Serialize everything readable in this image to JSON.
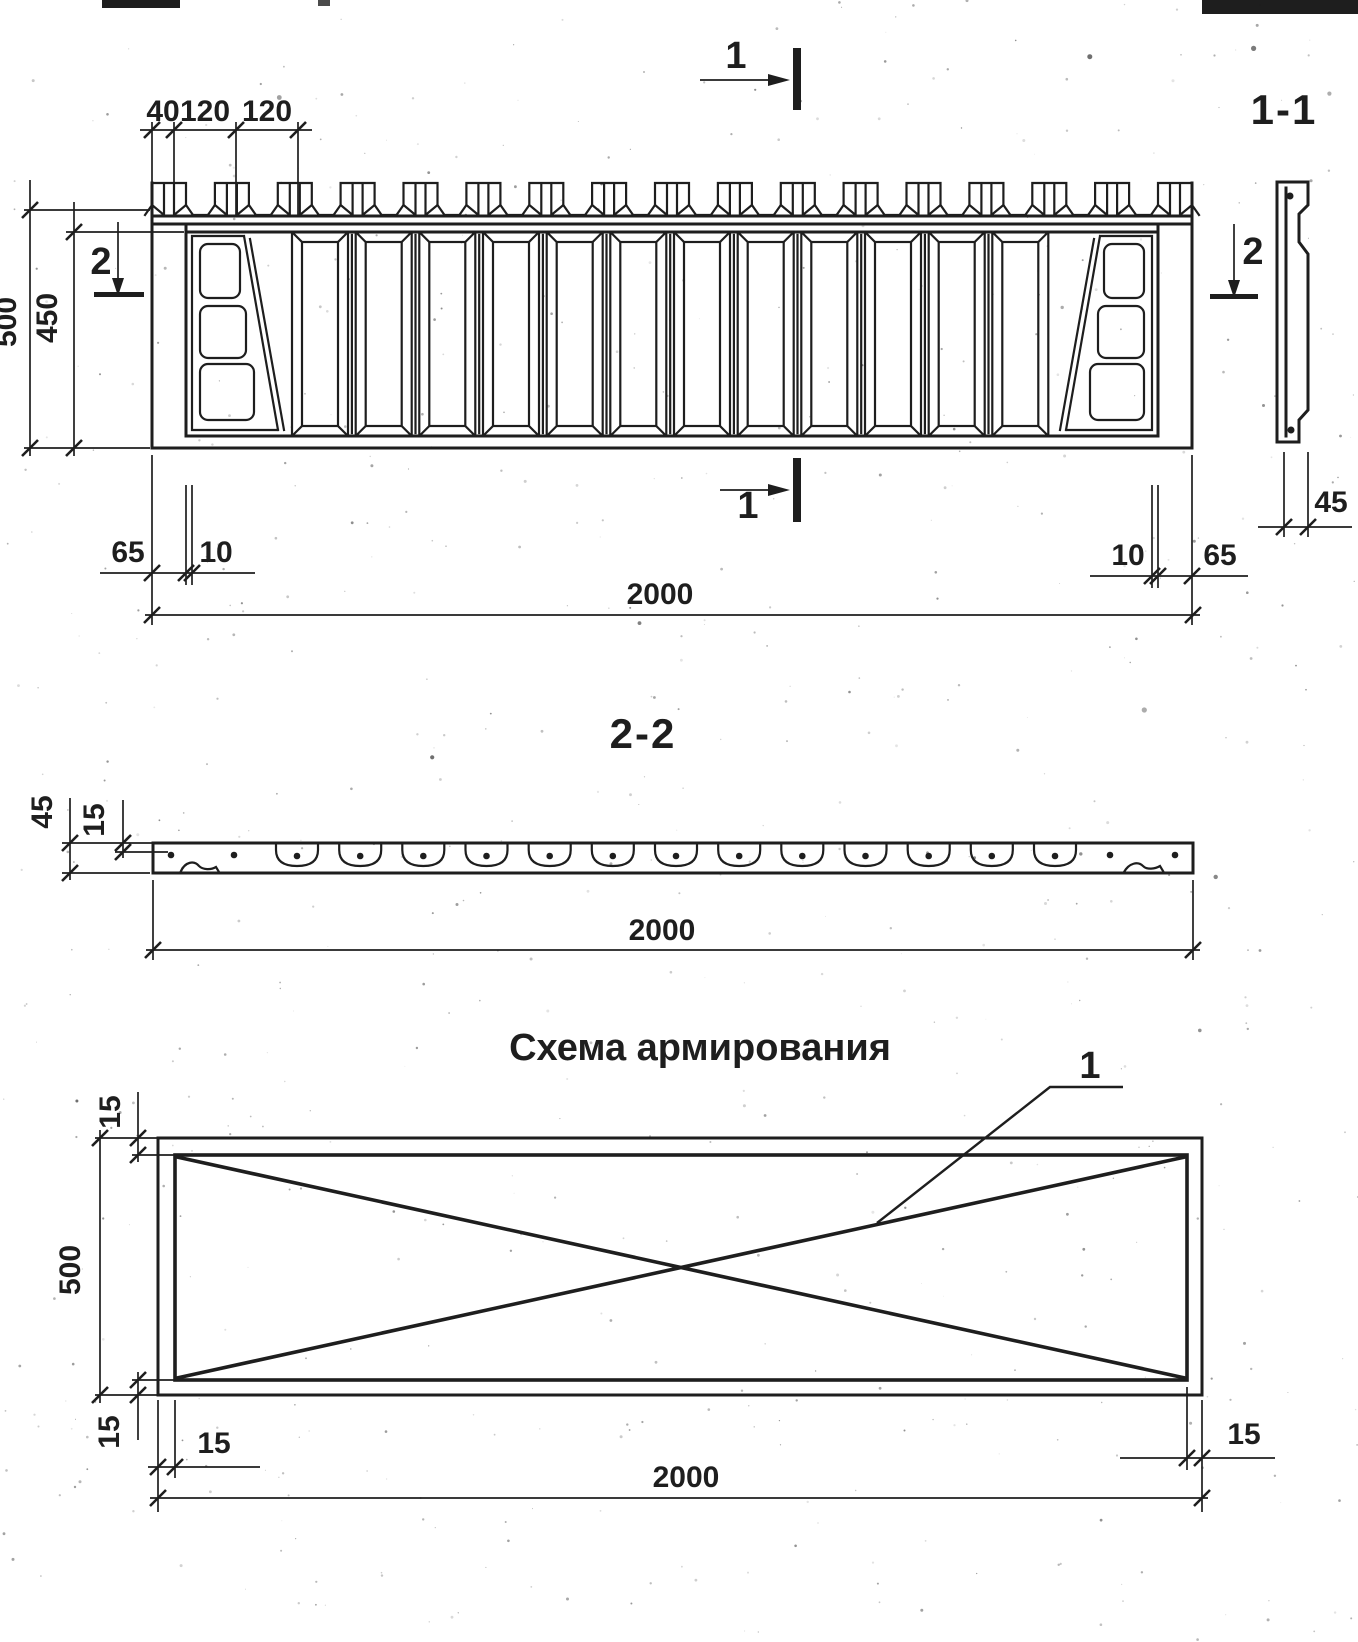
{
  "document": {
    "ink_color": "#1e1e1e",
    "paper_color": "#ffffff"
  },
  "drawing": {
    "elevation": {
      "marker_top": "1",
      "marker_bottom": "1",
      "marker_left": "2",
      "marker_right": "2",
      "dims": {
        "edge_offset": "40",
        "tooth_pitch_1": "120",
        "tooth_pitch_2": "120",
        "height_overall": "500",
        "height_field": "450",
        "end_left": "65",
        "gap_left": "10",
        "gap_right": "10",
        "end_right": "65",
        "length_overall": "2000"
      },
      "teeth_count": 17,
      "baluster_count": 12,
      "end_window_count": 3
    },
    "section_1_1": {
      "title": "1-1",
      "dims": {
        "thickness": "45"
      }
    },
    "section_2_2": {
      "title": "2-2",
      "dims": {
        "height": "45",
        "rebar_depth": "15",
        "length_overall": "2000"
      },
      "cup_count": 13
    },
    "reinforcement": {
      "title": "Схема армирования",
      "callout_label": "1",
      "dims": {
        "cover_top": "15",
        "height_overall": "500",
        "cover_bottom": "15",
        "cover_left": "15",
        "cover_right": "15",
        "length_overall": "2000"
      }
    }
  }
}
